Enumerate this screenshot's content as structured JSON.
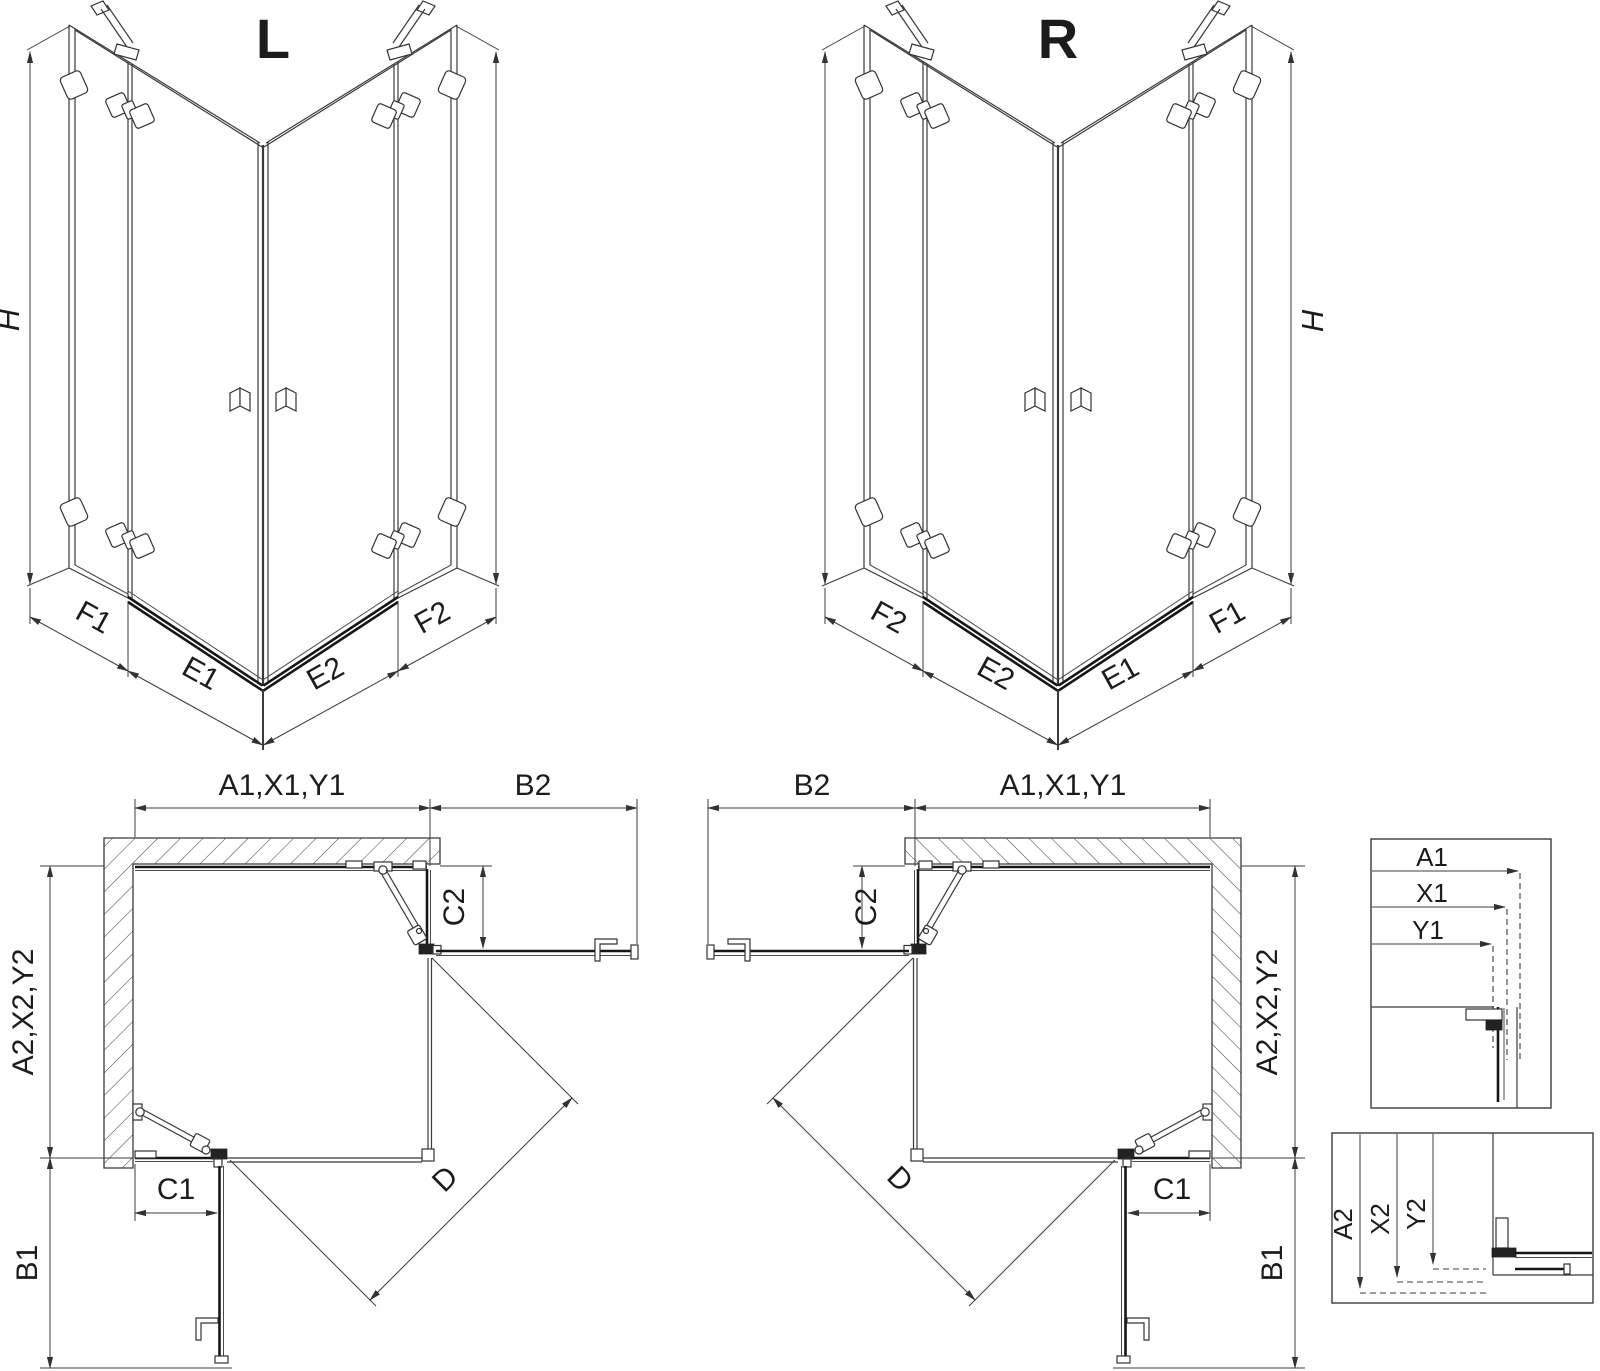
{
  "colors": {
    "background": "#ffffff",
    "line": "#3a3a3a",
    "line_dark": "#161616",
    "text": "#1c1c1c"
  },
  "views": {
    "perspective_left": {
      "title": "L",
      "height_label": "H",
      "bottom_labels": [
        "F1",
        "E1",
        "E2",
        "F2"
      ]
    },
    "perspective_right": {
      "title": "R",
      "height_label": "H",
      "bottom_labels": [
        "F2",
        "E2",
        "E1",
        "F1"
      ]
    },
    "plan_left": {
      "top_width_label": "A1,X1,Y1",
      "door_reach_side_label": "B2",
      "return_panel_label": "C2",
      "side_depth_label": "A2,X2,Y2",
      "bottom_panel_label": "C1",
      "door_reach_bottom_label": "B1",
      "diagonal_label": "D"
    },
    "plan_right": {
      "top_width_label": "A1,X1,Y1",
      "door_reach_side_label": "B2",
      "return_panel_label": "C2",
      "side_depth_label": "A2,X2,Y2",
      "bottom_panel_label": "C1",
      "door_reach_bottom_label": "B1",
      "diagonal_label": "D"
    },
    "detail_top": {
      "labels": [
        "A1",
        "X1",
        "Y1"
      ]
    },
    "detail_bottom": {
      "labels": [
        "A2",
        "X2",
        "Y2"
      ]
    }
  }
}
